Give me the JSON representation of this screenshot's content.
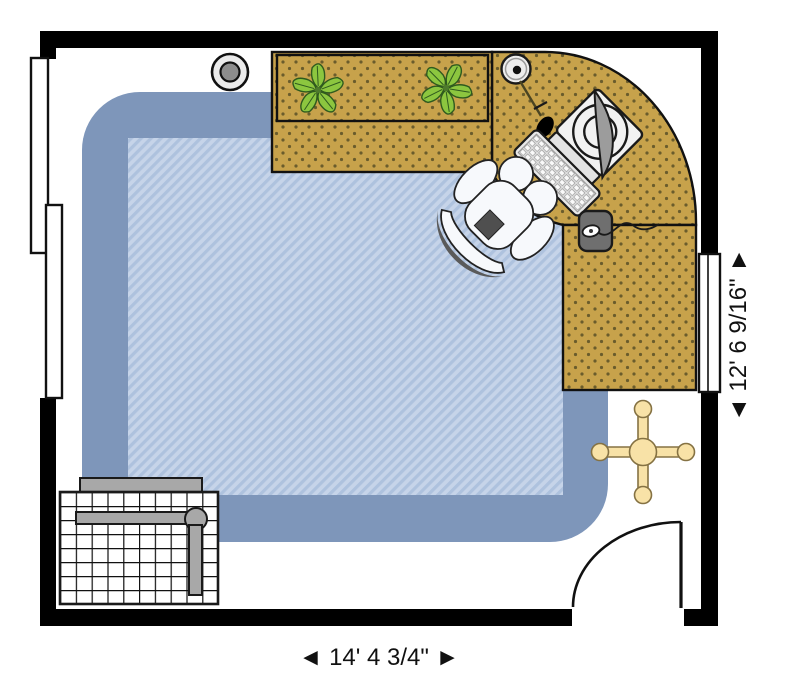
{
  "dimensions": {
    "width_label": "◄ 14' 4 3/4\" ►",
    "height_label": "◄ 12' 6 9/16\" ►",
    "room_width": "14' 4 3/4\"",
    "room_height": "12' 6 9/16\""
  },
  "colors": {
    "wall": "#000000",
    "rug_border": "#7e96ba",
    "rug_stripe_light": "#c6d4e9",
    "rug_stripe_dark": "#aec2de",
    "desk_surface": "#c7a24b",
    "desk_dots": "#6a5c2c",
    "fan": "#f8e2a7",
    "plant_leaf": "#8cc63f",
    "metal_gray": "#a8a8a8",
    "mousepad": "#6f6f6f",
    "chair": "#f7f9fc"
  },
  "items": {
    "rug": "area-rug",
    "desk_top": "desk-hutch-section",
    "desk_corner": "corner-desk-section",
    "desk_right": "desk-return-section",
    "plant_left": "potted-plant",
    "plant_right": "potted-plant",
    "lamp": "desk-lamp",
    "monitor": "crt-monitor",
    "keyboard": "keyboard",
    "mousepad": "mouse-pad-with-mouse",
    "chair": "office-chair",
    "fan": "ceiling-fan",
    "detector": "smoke-detector",
    "drafting_table": "drafting-table",
    "door": "door",
    "window_left_upper": "window",
    "window_left_lower": "window",
    "window_right": "window"
  }
}
